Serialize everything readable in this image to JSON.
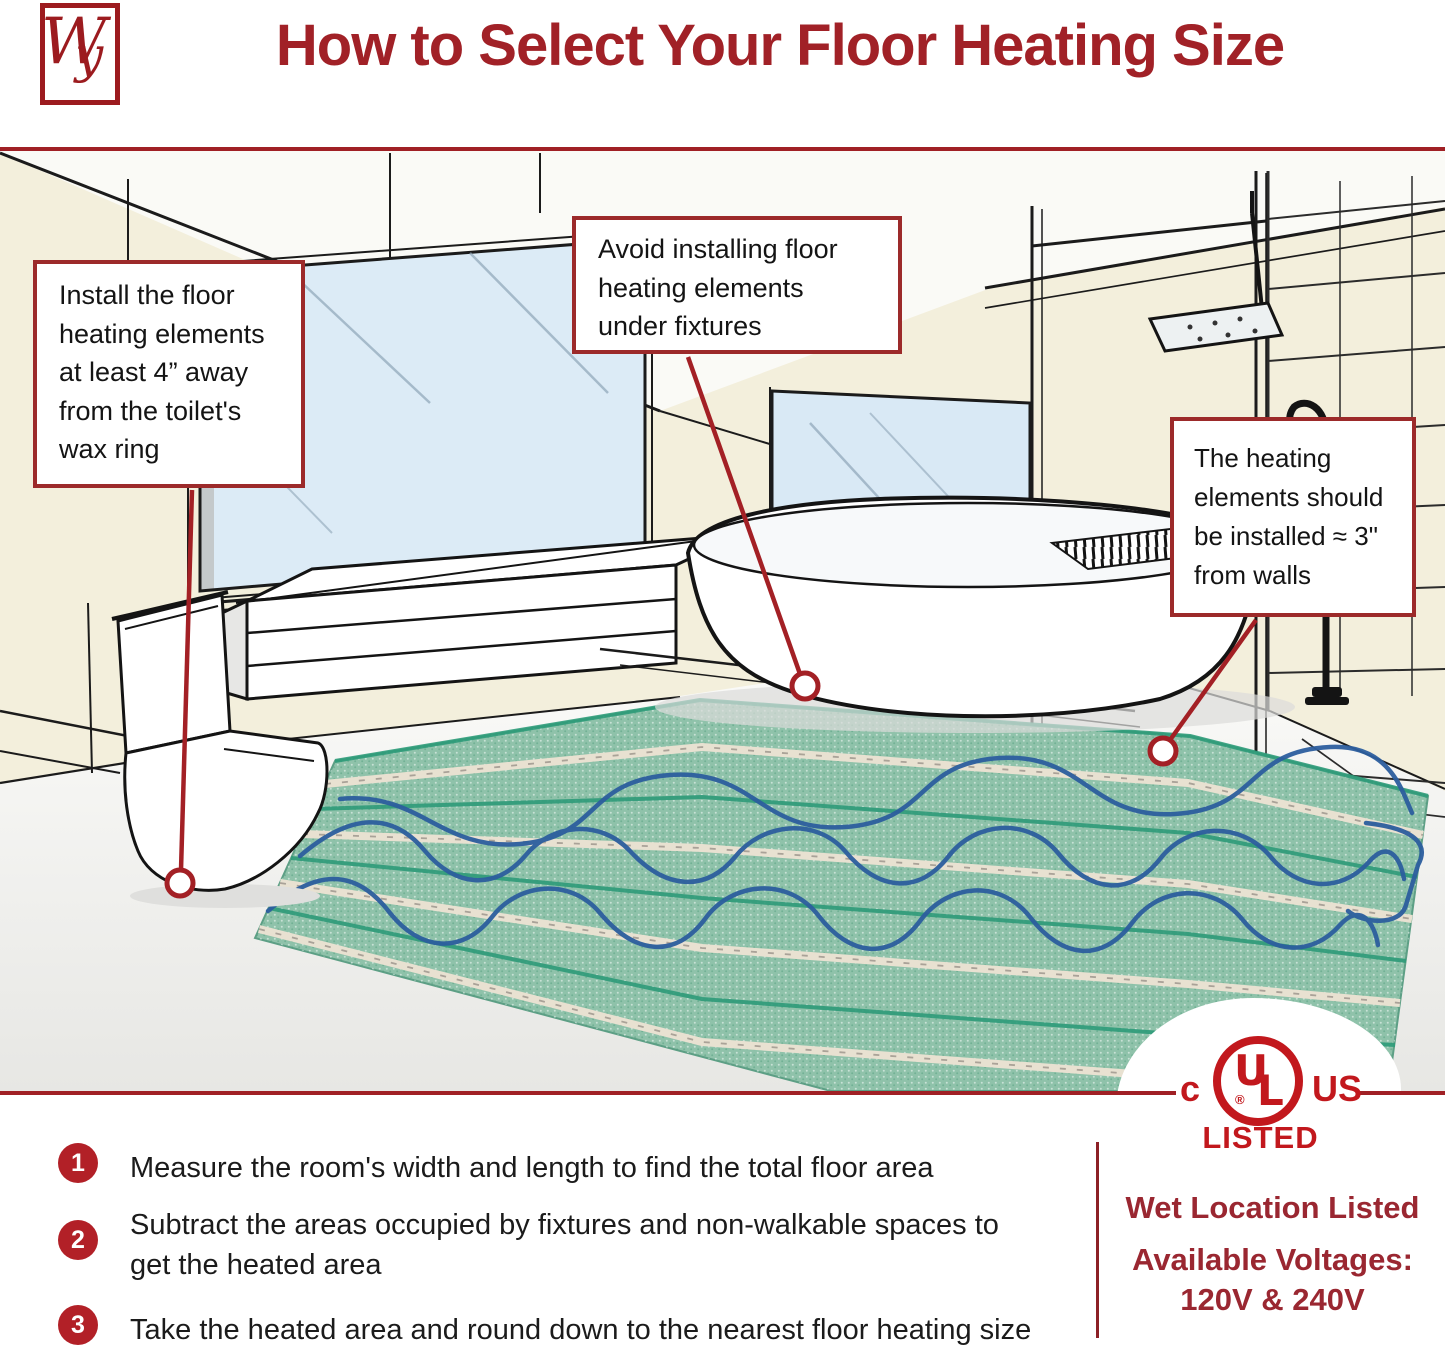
{
  "header": {
    "logo_initial_w": "W",
    "logo_initial_y": "y",
    "title": "How to Select Your Floor Heating Size"
  },
  "callouts": {
    "toilet_note": "Install the floor\nheating elements\nat least 4” away\nfrom the toilet's\nwax ring",
    "fixtures_note": "Avoid installing floor\nheating elements\nunder fixtures",
    "walls_note": "The heating\nelements should\nbe installed ≈ 3\"\nfrom walls"
  },
  "steps": [
    {
      "number": "1",
      "text": "Measure the room's width and length to find the total floor area"
    },
    {
      "number": "2",
      "text": "Subtract the areas occupied by fixtures and non-walkable spaces to\nget the heated area"
    },
    {
      "number": "3",
      "text": "Take the heated area and round down to the nearest floor heating size"
    }
  ],
  "certification": {
    "c_mark": "c",
    "ul_u": "U",
    "ul_l": "L",
    "registered": "®",
    "us_mark": "US",
    "listed": "LISTED",
    "wet_location": "Wet Location Listed",
    "voltages_label": "Available Voltages:",
    "voltages_value": "120V & 240V"
  },
  "colors": {
    "accent_red": "#A02025",
    "ul_red": "#C2181D",
    "step_circle_red": "#B22027",
    "wall_cream": "#F3EFDC",
    "glass_blue": "#DCEBF6",
    "mat_green": "#8FC2AA",
    "cable_blue": "#2C5E9E",
    "text_black": "#1b1b1b"
  }
}
